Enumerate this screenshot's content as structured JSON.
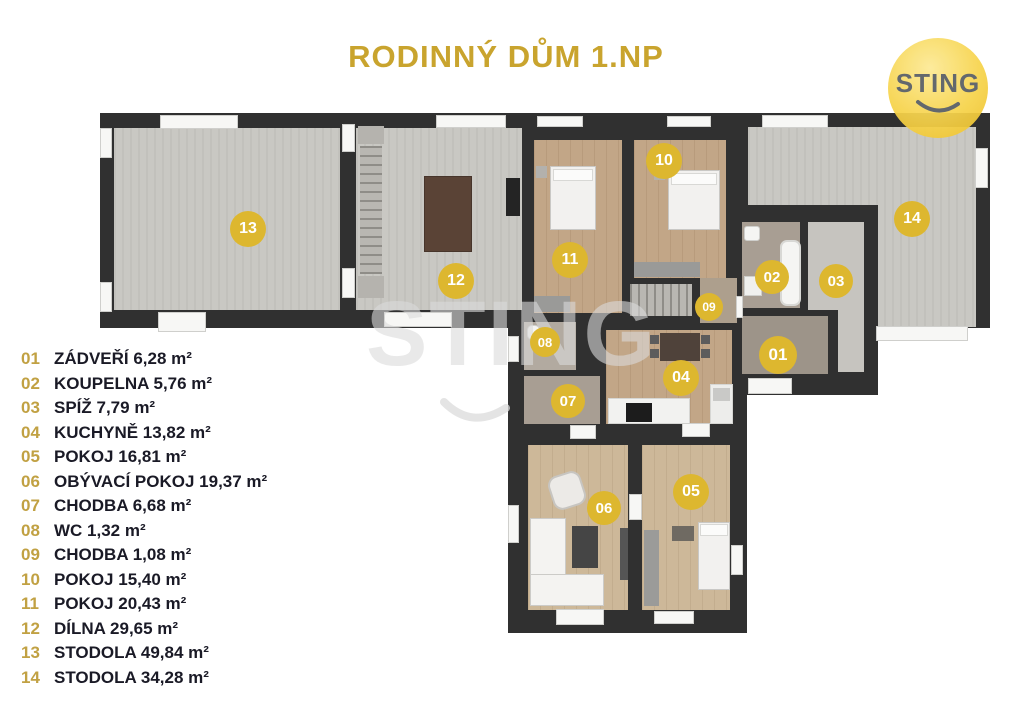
{
  "page": {
    "title": "RODINNÝ DŮM 1.NP"
  },
  "logo": {
    "text": "STING"
  },
  "watermark": {
    "text": "STING"
  },
  "legend": {
    "items": [
      {
        "number": "01",
        "label": "ZÁDVEŘÍ 6,28 m²"
      },
      {
        "number": "02",
        "label": "KOUPELNA 5,76 m²"
      },
      {
        "number": "03",
        "label": "SPÍŽ 7,79 m²"
      },
      {
        "number": "04",
        "label": "KUCHYNĚ 13,82 m²"
      },
      {
        "number": "05",
        "label": "POKOJ 16,81 m²"
      },
      {
        "number": "06",
        "label": "OBÝVACÍ POKOJ 19,37 m²"
      },
      {
        "number": "07",
        "label": "CHODBA 6,68 m²"
      },
      {
        "number": "08",
        "label": "WC 1,32 m²"
      },
      {
        "number": "09",
        "label": "CHODBA 1,08 m²"
      },
      {
        "number": "10",
        "label": "POKOJ 15,40 m²"
      },
      {
        "number": "11",
        "label": "POKOJ 20,43 m²"
      },
      {
        "number": "12",
        "label": "DÍLNA 29,65 m²"
      },
      {
        "number": "13",
        "label": "STODOLA 49,84 m²"
      },
      {
        "number": "14",
        "label": "STODOLA 34,28 m²"
      }
    ]
  },
  "floorplan": {
    "badges": [
      {
        "number": "13",
        "x": 248,
        "y": 229,
        "d": 36
      },
      {
        "number": "12",
        "x": 456,
        "y": 281,
        "d": 36
      },
      {
        "number": "11",
        "x": 570,
        "y": 260,
        "d": 36
      },
      {
        "number": "10",
        "x": 664,
        "y": 161,
        "d": 36
      },
      {
        "number": "14",
        "x": 912,
        "y": 219,
        "d": 36
      },
      {
        "number": "02",
        "x": 772,
        "y": 277,
        "d": 34
      },
      {
        "number": "03",
        "x": 836,
        "y": 281,
        "d": 34
      },
      {
        "number": "01",
        "x": 778,
        "y": 355,
        "d": 38
      },
      {
        "number": "09",
        "x": 709,
        "y": 307,
        "d": 28
      },
      {
        "number": "08",
        "x": 545,
        "y": 342,
        "d": 30
      },
      {
        "number": "07",
        "x": 568,
        "y": 401,
        "d": 34
      },
      {
        "number": "04",
        "x": 681,
        "y": 378,
        "d": 36
      },
      {
        "number": "06",
        "x": 604,
        "y": 508,
        "d": 34
      },
      {
        "number": "05",
        "x": 691,
        "y": 492,
        "d": 36
      }
    ]
  },
  "colors": {
    "title": "#C9A42E",
    "legend_number": "#C1A143",
    "legend_label": "#1A1A26",
    "badge": "#DDB72F",
    "badge_text": "#FFFFFF",
    "wall": "#303030",
    "logo_circle": "#F5CE3E",
    "logo_text": "#585D62",
    "floor_concrete": "#C9C8C3",
    "floor_wood": "#C2A687",
    "floor_wood_light": "#CDB899",
    "floor_tile": "#A89E93",
    "watermark_gray": "#DBDBDB"
  }
}
